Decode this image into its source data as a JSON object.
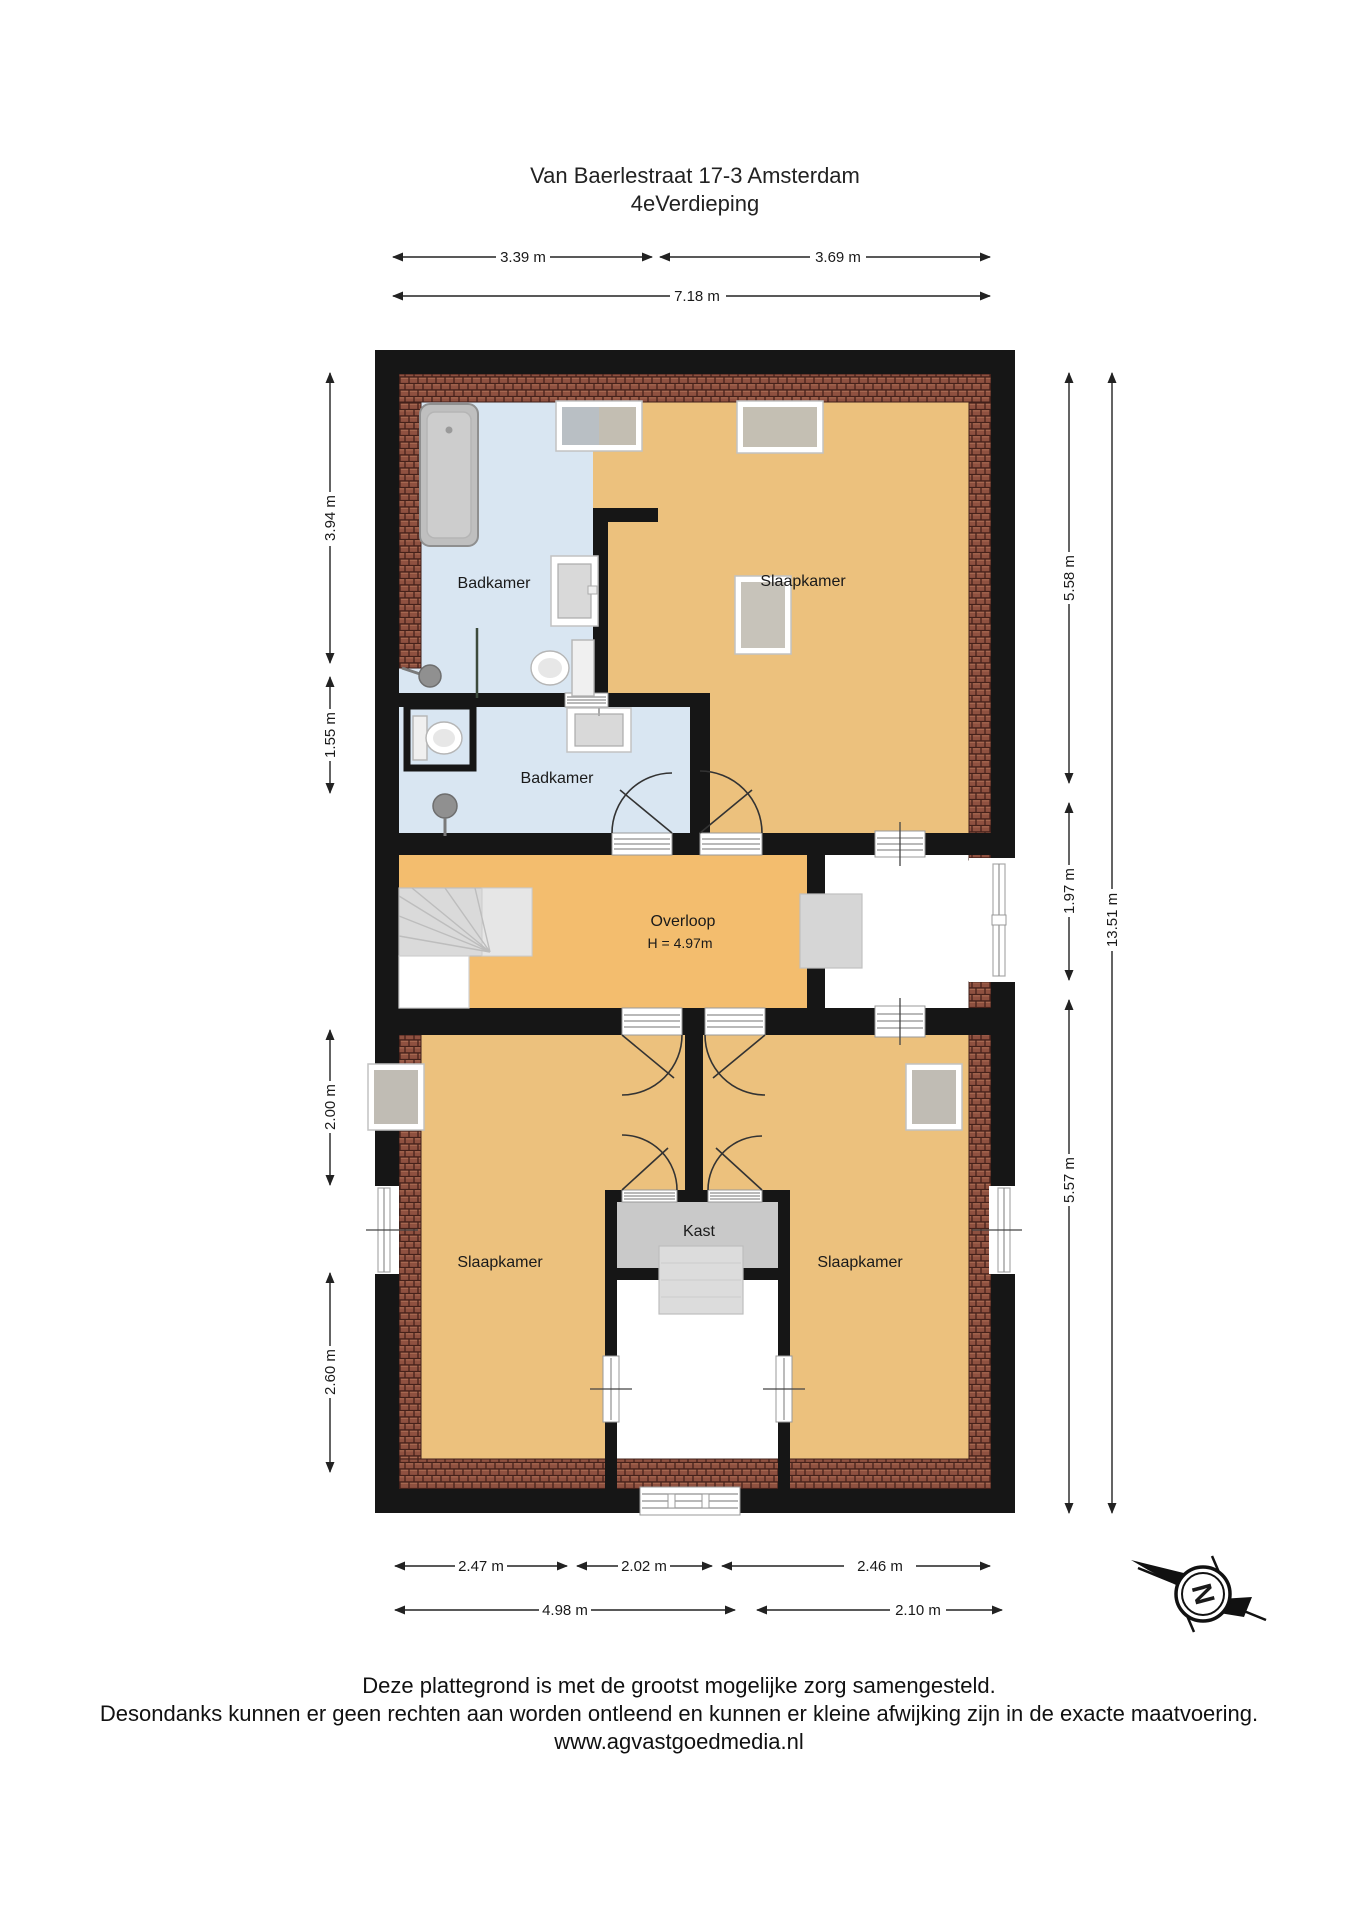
{
  "title": {
    "line1": "Van Baerlestraat 17-3 Amsterdam",
    "line2": "4eVerdieping"
  },
  "rooms": {
    "badkamer_top": {
      "label": "Badkamer"
    },
    "slaapkamer_top": {
      "label": "Slaapkamer"
    },
    "badkamer_mid": {
      "label": "Badkamer"
    },
    "overloop": {
      "label": "Overloop",
      "height": "H = 4.97m"
    },
    "kast": {
      "label": "Kast"
    },
    "slaapkamer_links": {
      "label": "Slaapkamer"
    },
    "slaapkamer_rechts": {
      "label": "Slaapkamer"
    }
  },
  "dimensions": {
    "top_left": "3.39 m",
    "top_right": "3.69 m",
    "top_total": "7.18 m",
    "left_1": "3.94 m",
    "left_2": "1.55 m",
    "left_3": "2.00 m",
    "left_4": "2.60 m",
    "right_1": "5.58 m",
    "right_2": "1.97 m",
    "right_3": "5.57 m",
    "right_total": "13.51 m",
    "bottom_1": "2.47 m",
    "bottom_2": "2.02 m",
    "bottom_3": "2.46 m",
    "bottom_4": "4.98 m",
    "bottom_5": "2.10 m"
  },
  "compass": {
    "north": "N"
  },
  "footer": {
    "line1": "Deze plattegrond is met de grootst mogelijke zorg samengesteld.",
    "line2": "Desondanks kunnen er geen rechten aan worden ontleend en kunnen er kleine afwijking zijn in de exacte maatvoering.",
    "line3": "www.agvastgoedmedia.nl"
  },
  "colors": {
    "wall": "#161616",
    "bedroom": "#ecc17d",
    "hallway": "#f3bd6e",
    "bathroom": "#d9e6f2",
    "closet": "#c9c9c9",
    "roof_tiles": "#8f5140",
    "background": "#ffffff"
  }
}
